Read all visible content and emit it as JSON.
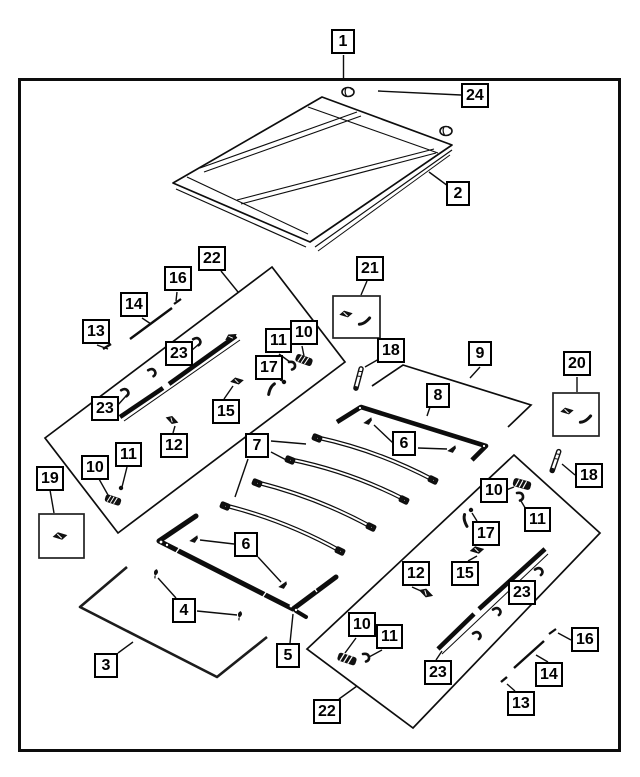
{
  "diagram_title": "Soft Top Parts Diagram",
  "colors": {
    "line": "#0d0d0d",
    "background": "#ffffff",
    "label_border": "#000000"
  },
  "callouts": [
    {
      "label": "1"
    },
    {
      "label": "24"
    },
    {
      "label": "2"
    },
    {
      "label": "22"
    },
    {
      "label": "16"
    },
    {
      "label": "14"
    },
    {
      "label": "13"
    },
    {
      "label": "21"
    },
    {
      "label": "23"
    },
    {
      "label": "23"
    },
    {
      "label": "10"
    },
    {
      "label": "11"
    },
    {
      "label": "17"
    },
    {
      "label": "15"
    },
    {
      "label": "12"
    },
    {
      "label": "18"
    },
    {
      "label": "9"
    },
    {
      "label": "8"
    },
    {
      "label": "20"
    },
    {
      "label": "7"
    },
    {
      "label": "6"
    },
    {
      "label": "18"
    },
    {
      "label": "19"
    },
    {
      "label": "10"
    },
    {
      "label": "11"
    },
    {
      "label": "6"
    },
    {
      "label": "4"
    },
    {
      "label": "3"
    },
    {
      "label": "5"
    },
    {
      "label": "22"
    },
    {
      "label": "10"
    },
    {
      "label": "11"
    },
    {
      "label": "10"
    },
    {
      "label": "11"
    },
    {
      "label": "17"
    },
    {
      "label": "15"
    },
    {
      "label": "12"
    },
    {
      "label": "23"
    },
    {
      "label": "23"
    },
    {
      "label": "16"
    },
    {
      "label": "14"
    },
    {
      "label": "13"
    }
  ]
}
